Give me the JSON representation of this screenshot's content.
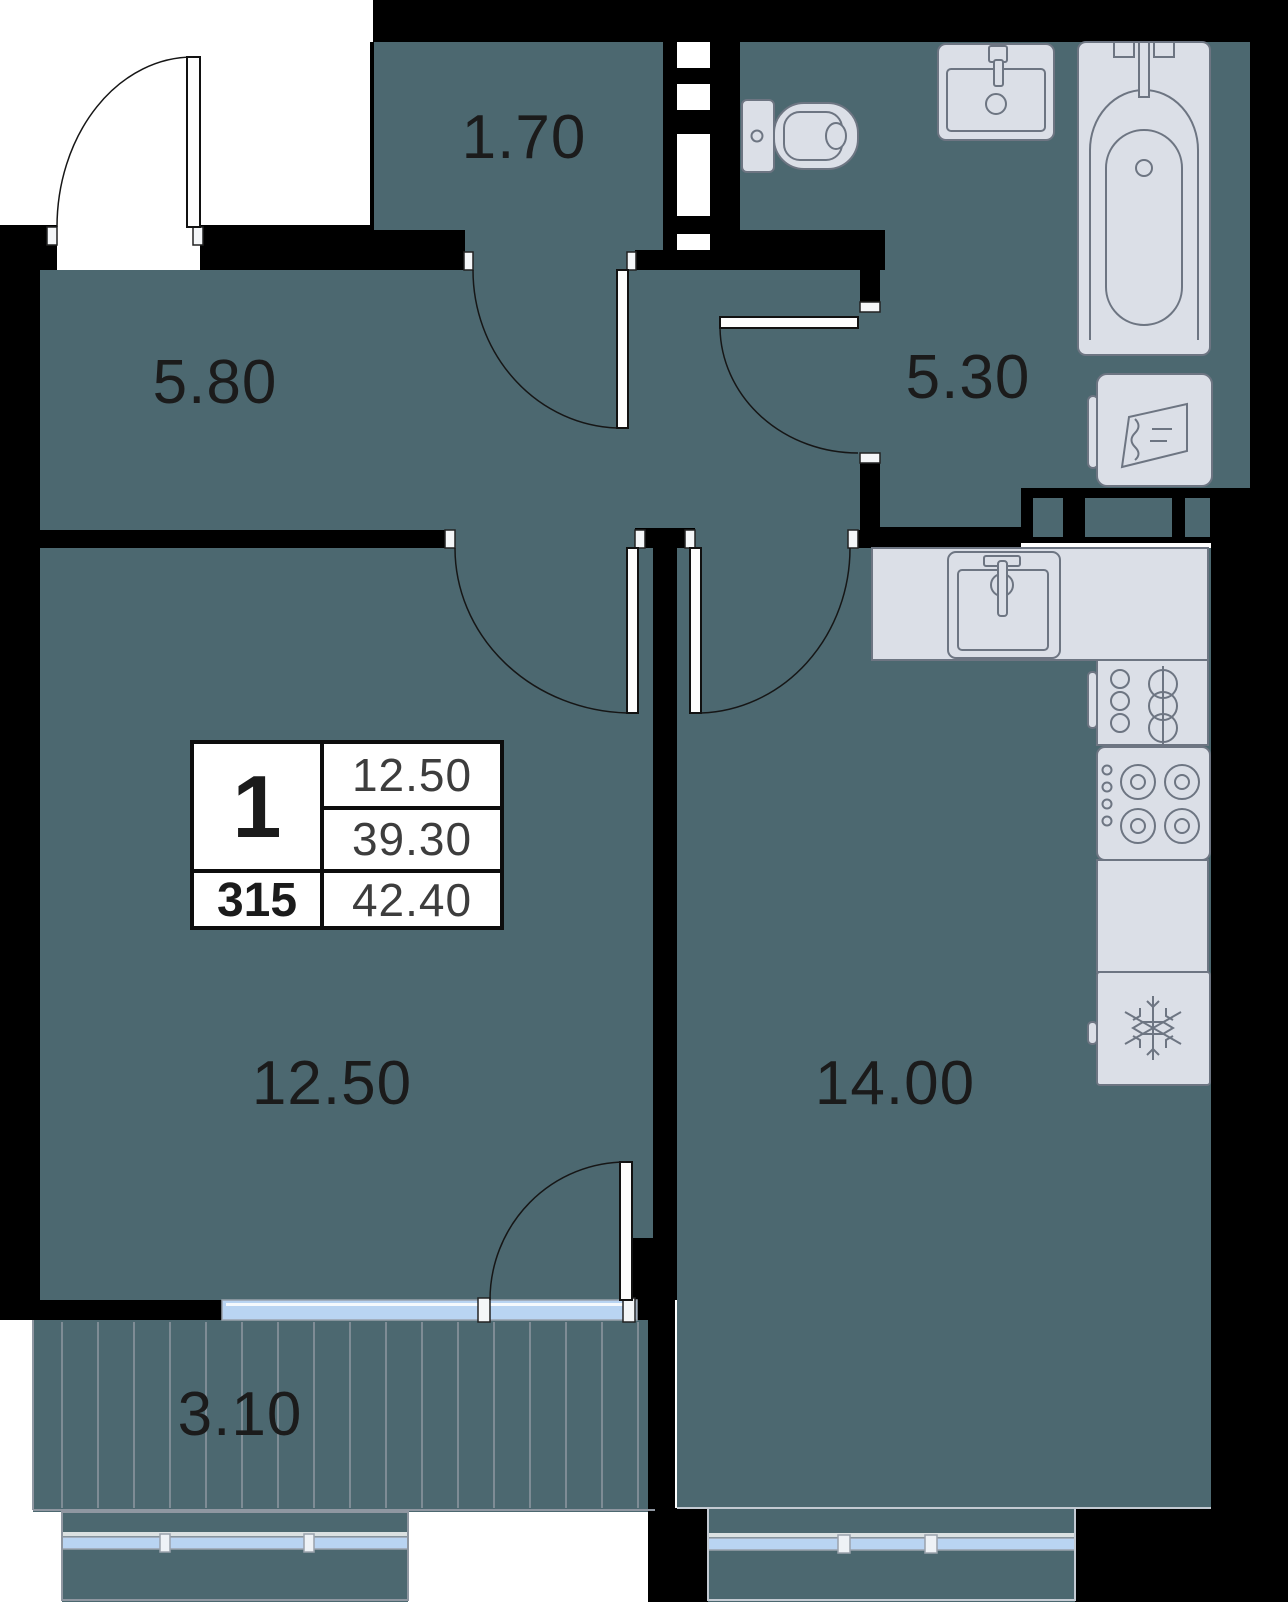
{
  "colors": {
    "floor": "#4c6870",
    "wall": "#000000",
    "fixture_fill": "#dbdfe7",
    "fixture_stroke": "#6d7582",
    "window_glass": "#b9d4f2",
    "frame_line": "#9aa2ac",
    "deck_line": "#8f97a1",
    "label_ink": "#1b1b1b"
  },
  "plan": {
    "rooms": {
      "hallway": {
        "label": "5.80"
      },
      "wardrobe": {
        "label": "1.70"
      },
      "bathroom": {
        "label": "5.30"
      },
      "living_room": {
        "label": "12.50"
      },
      "kitchen": {
        "label": "14.00"
      },
      "balcony": {
        "label": "3.10"
      }
    },
    "info_table": {
      "rooms_count": "1",
      "unit_number": "315",
      "row1_area": "12.50",
      "row2_area": "39.30",
      "row3_area": "42.40"
    },
    "fixtures": [
      "toilet",
      "bathroom-sink",
      "bathtub",
      "washing-machine",
      "kitchen-sink",
      "dish-rack",
      "stove",
      "fridge",
      "vent-shaft"
    ]
  }
}
